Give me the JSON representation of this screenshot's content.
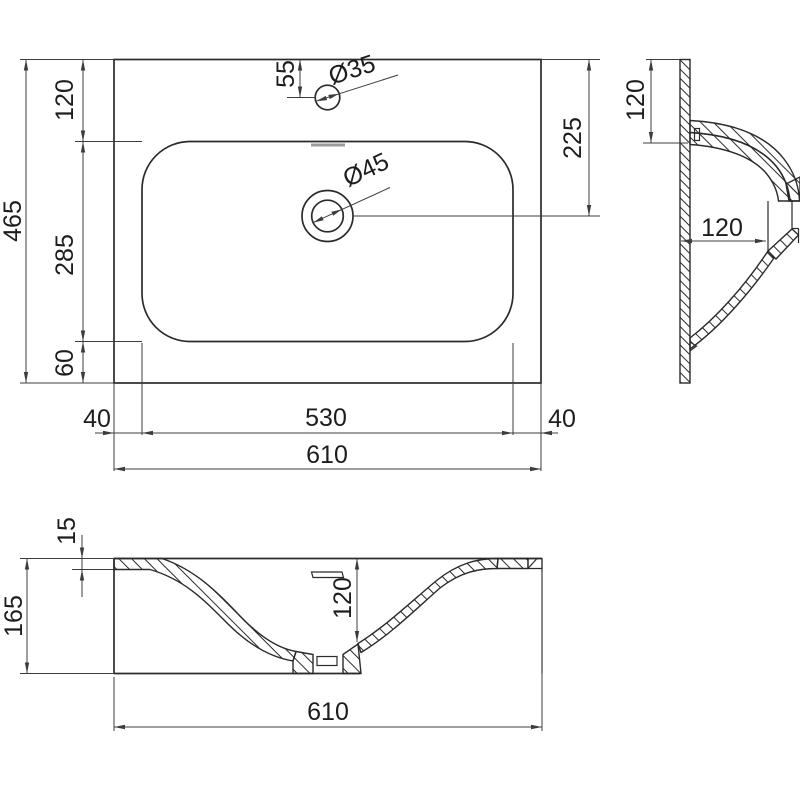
{
  "plan_view": {
    "total_width": "610",
    "total_height": "465",
    "top_offset": "120",
    "basin_length": "285",
    "bottom_offset": "60",
    "left_margin": "40",
    "basin_width": "530",
    "right_margin": "40",
    "faucet_offset": "55",
    "faucet_hole": "Ø35",
    "drain_hole": "Ø45",
    "drain_from_top": "225"
  },
  "side_view": {
    "ledge_height": "120",
    "drain_inset": "120"
  },
  "front_section": {
    "rim_thickness": "15",
    "overall_height": "165",
    "basin_depth": "120",
    "overall_width": "610"
  },
  "colors": {
    "line": "#2b2b2b",
    "dimension": "#3d3d3d",
    "text": "#1d1d1d",
    "overflow_mark": "#9c9c9c",
    "background": "#ffffff"
  }
}
